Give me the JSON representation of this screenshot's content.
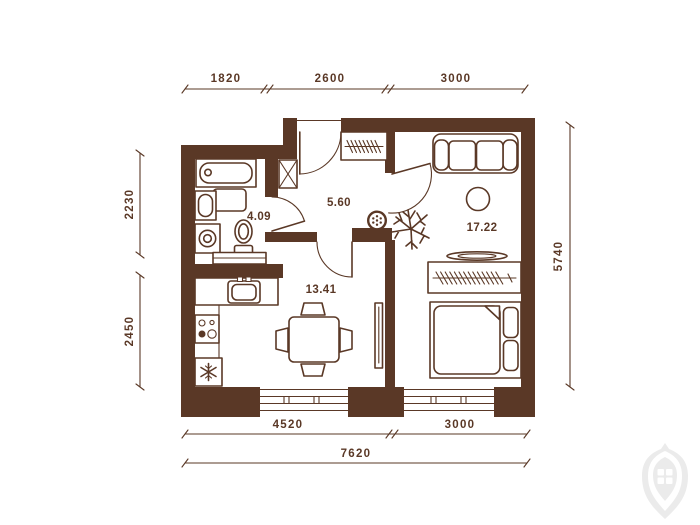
{
  "colors": {
    "wall": "#5A3826",
    "background": "#FFFFFF",
    "watermark": "#EBEBEB"
  },
  "dimensions": {
    "top": [
      "1820",
      "2600",
      "3000"
    ],
    "left": [
      "2230",
      "2450"
    ],
    "right": [
      "5740"
    ],
    "bottom": [
      "4520",
      "3000"
    ],
    "overall": "7620"
  },
  "rooms": {
    "bathroom": {
      "area": "4.09"
    },
    "hallway": {
      "area": "5.60"
    },
    "kitchen_living": {
      "area": "13.41"
    },
    "living_bedroom": {
      "area": "17.22"
    }
  },
  "furniture": [
    "bathtub",
    "washbasin",
    "bathroom-cabinet",
    "washing-machine",
    "toilet",
    "vanity-counter",
    "ventilation-shaft",
    "coat-closet-hangers",
    "kitchen-sink",
    "stove",
    "fridge",
    "dining-table-chairs",
    "tv",
    "sofa",
    "round-table",
    "plant",
    "wall-vent",
    "wardrobe-hangers",
    "shelf-tray",
    "double-bed"
  ],
  "doors": [
    "entrance-door",
    "bathroom-door",
    "kitchen-door",
    "room-door"
  ],
  "windows": [
    "kitchen-window",
    "bedroom-window"
  ],
  "watermark": "developer-logo"
}
